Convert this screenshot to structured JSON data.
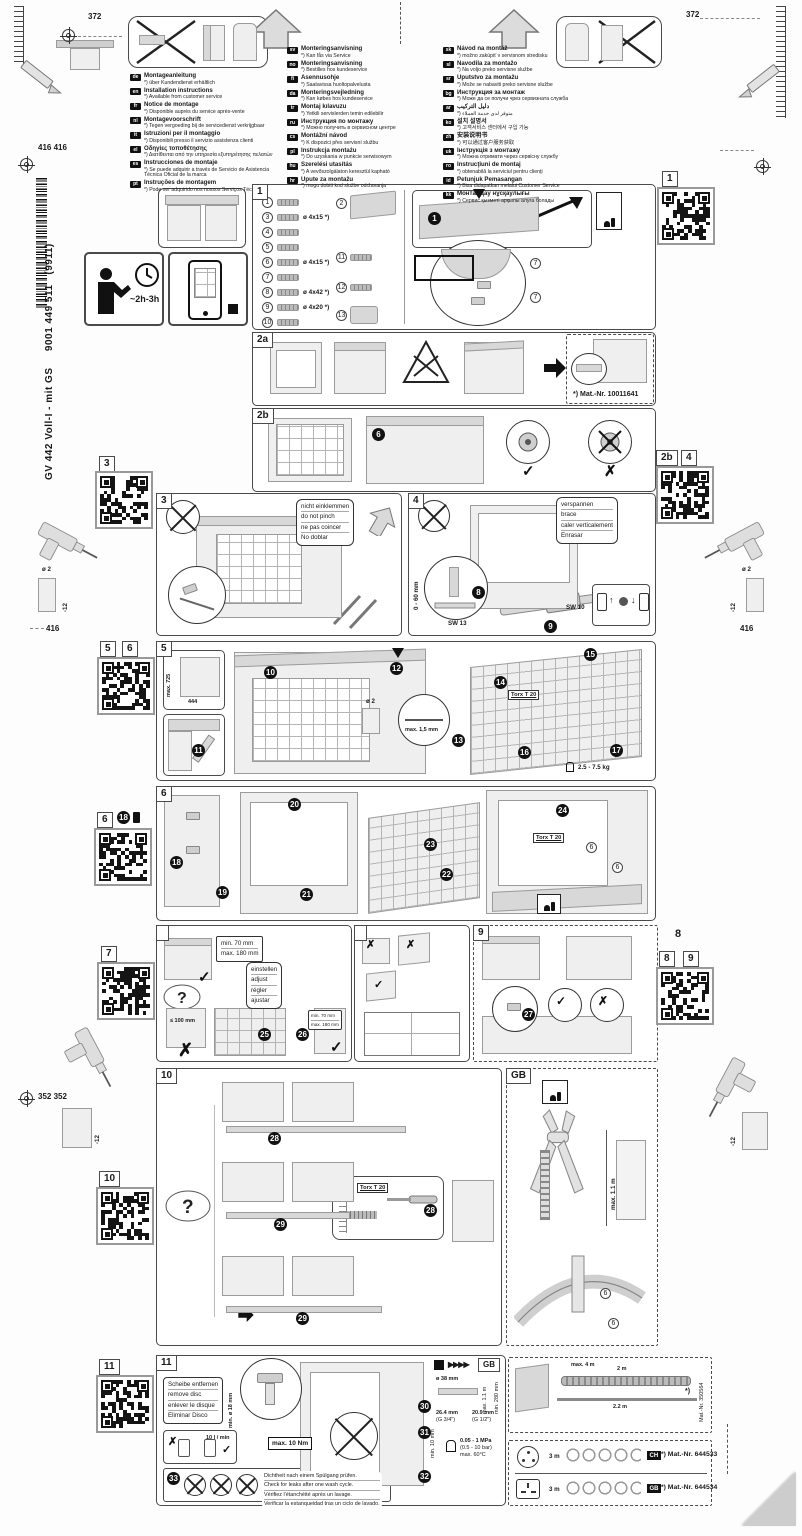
{
  "meta": {
    "product": "GV 442 Voll-I - mit GS",
    "doc_number": "9001 449 511",
    "doc_revision": "(9911)",
    "duration": "~2h-3h"
  },
  "dims": {
    "d372": "372",
    "d416416": "416 416",
    "d416": "416",
    "d352352": "352 352",
    "drill_dia": "ø 2",
    "drill_depth": "-12"
  },
  "glyphs": {
    "check": "✓",
    "cross": "✗",
    "question": "?",
    "asterisk": "*)"
  },
  "languages": {
    "col1": [
      {
        "code": "de",
        "title": "Montageanleitung",
        "note": "*) über Kundendienst erhältlich"
      },
      {
        "code": "en",
        "title": "Installation instructions",
        "note": "*) Available from customer service"
      },
      {
        "code": "fr",
        "title": "Notice de montage",
        "note": "*) Disponible auprès du service après-vente"
      },
      {
        "code": "nl",
        "title": "Montagevoorschrift",
        "note": "*) Tegen vergoeding bij de servicedienst verkrijgbaar"
      },
      {
        "code": "it",
        "title": "Istruzioni per il montaggio",
        "note": "*) Disponibili presso il servizio assistenza clienti"
      },
      {
        "code": "el",
        "title": "Οδηγίες τοποθέτησης",
        "note": "*) Διατίθενται από την υπηρεσία εξυπηρέτησης πελατών"
      },
      {
        "code": "es",
        "title": "Instrucciones de montaje",
        "note": "*) Se puede adquirir a través de Servicio de Asistencia Técnica Oficial de la marca"
      },
      {
        "code": "pt",
        "title": "Instruções de montagem",
        "note": "*) Pode ser adquirido nos nossos Serviços Técnicos"
      }
    ],
    "col2": [
      {
        "code": "sv",
        "title": "Monteringsanvisning",
        "note": "*) Kan fås via Service"
      },
      {
        "code": "no",
        "title": "Monteringsanvisning",
        "note": "*) Bestilles hos kundeservice"
      },
      {
        "code": "fi",
        "title": "Asennusohje",
        "note": "*) Saatavissa huoltopalvelusta"
      },
      {
        "code": "da",
        "title": "Monteringsvejledning",
        "note": "*) Kan købes hos kundeservice"
      },
      {
        "code": "tr",
        "title": "Montaj kılavuzu",
        "note": "*) Yetkili servislerden temin edilebilir"
      },
      {
        "code": "ru",
        "title": "Инструкция по монтажу",
        "note": "*) Можно получить в сервисном центре"
      },
      {
        "code": "cs",
        "title": "Montážní návod",
        "note": "*) K dispozici přes servisní službu"
      },
      {
        "code": "pl",
        "title": "Instrukcja montażu",
        "note": "*) Do uzyskania w punkcie serwisowym"
      },
      {
        "code": "hu",
        "title": "Szerelési utasítás",
        "note": "*) A vevőszolgálaton keresztül kapható"
      },
      {
        "code": "hr",
        "title": "Upute za montažu",
        "note": "*) mogu dobiti kod službe održavanja"
      }
    ],
    "col3": [
      {
        "code": "sk",
        "title": "Návod na montáž",
        "note": "*) možno zakúpiť v servisnom stredisku"
      },
      {
        "code": "sl",
        "title": "Navodila za montažo",
        "note": "*) Na voljo preko servisne službe"
      },
      {
        "code": "sr",
        "title": "Uputstvo za montažu",
        "note": "*) Može se nabaviti preko servisne službe"
      },
      {
        "code": "bg",
        "title": "Инструкция за монтаж",
        "note": "*) Може да се получи чрез сервизната служба"
      },
      {
        "code": "ar",
        "title": "دليل التركيب",
        "note": "*) متوفر لدى خدمة العملاء"
      },
      {
        "code": "ko",
        "title": "설치 설명서",
        "note": "*) 고객서비스 센터에서 구입 가능"
      },
      {
        "code": "zh",
        "title": "安装说明书",
        "note": "*) 可以通过客户服务获取"
      },
      {
        "code": "uk",
        "title": "Інструкція з монтажу",
        "note": "*) Можна отримати через сервісну службу"
      },
      {
        "code": "ro",
        "title": "Instrucţiuni de montaj",
        "note": "*) obtenabilă la serviciul pentru clienţi"
      },
      {
        "code": "id",
        "title": "Petunjuk Pemasangan",
        "note": "*) Bisa didapatkan melalui Customer Service"
      },
      {
        "code": "kk",
        "title": "Монтаждау нұсқаулығы",
        "note": "*) Сервис қызметі арқылы алуға болады"
      }
    ]
  },
  "steps": {
    "s1": "1",
    "s2a": "2a",
    "s2b": "2b",
    "s3": "3",
    "s4": "4",
    "s5": "5",
    "s6": "6",
    "s9": "9",
    "s10": "10",
    "s11": "11",
    "gb": "GB",
    "s8_floating": "8"
  },
  "qr_labels": {
    "q1": "1",
    "q2b": "2b",
    "q4": "4",
    "q3": "3",
    "q5": "5",
    "q6": "6",
    "q6b": "6",
    "q18": "18",
    "q7": "7",
    "q8": "8",
    "q9": "9",
    "q10": "10",
    "q11": "11"
  },
  "nums": {
    "n1": "1",
    "n2": "2",
    "n3": "3",
    "n4": "4",
    "n5": "5",
    "n6": "6",
    "n7": "7",
    "n8": "8",
    "n9": "9",
    "n10": "10",
    "n11": "11",
    "n12": "12",
    "n13": "13",
    "n14": "14",
    "n15": "15",
    "n16": "16",
    "n17": "17",
    "n18": "18",
    "n19": "19",
    "n20": "20",
    "n21": "21",
    "n22": "22",
    "n23": "23",
    "n24": "24",
    "n25": "25",
    "n26": "26",
    "n27": "27",
    "n28": "28",
    "n29": "29",
    "n30": "30",
    "n31": "31",
    "n32": "32",
    "n33": "33"
  },
  "sizes": {
    "s415": "ø 4x15 *)",
    "s442": "ø 4x42 *)",
    "s420": "ø 4x20 *)"
  },
  "annot": {
    "mat_2a": "*) Mat.-Nr. 10011641",
    "torx": "Torx T 20",
    "s3_note": [
      "nicht einklemmen",
      "do not pinch",
      "ne pas coincer",
      "No doblar"
    ],
    "s4_note": [
      "verspannen",
      "brace",
      "caler verticalement",
      "Enrasar"
    ],
    "s4_range": "0 - 60 mm",
    "sw13": "SW 13",
    "sw10": "SW 10",
    "s5_h": "max. 725",
    "s5_w": "444",
    "s5_gap": "max. 1,5 mm",
    "s5_weight": "2.5 - 7.5 kg",
    "s7_min": "min. 70 mm",
    "s7_max": "max. 180 mm",
    "s7_lt": "≤ 100 mm",
    "s7_adjust": [
      "einstellen",
      "adjust",
      "régler",
      "ajustar"
    ],
    "s11_remove": [
      "Scheibe entfernen",
      "remove disc",
      "enlever le disque",
      "Eliminar Disco"
    ],
    "s11_dia": "min. ø 18 mm",
    "s11_flow": "10 l / min",
    "s11_torque": "max. 10 Nm",
    "s11_check": [
      "Dichtheit nach einem Spülgang prüfen.",
      "Check for leaks after one wash cycle.",
      "Vérifiez l'étanchéité après un lavage.",
      "Verificar la estanqueidad tras un ciclo de lavado."
    ],
    "s11_thread1a": "26.4 mm",
    "s11_thread1b": "(G 3/4\")",
    "s11_thread2a": "20.9 mm",
    "s11_thread2b": "(G 1/2\")",
    "s11_press1": "0.05 - 1 MPa",
    "s11_press2": "(0.5 - 10 bar)",
    "s11_press3": "max. 60°C",
    "s11_min10": "min. 10 mm",
    "s11_hose_dia": "ø 38 mm",
    "s11_hmax": "max. 1.1 m",
    "s11_hmin": "min. 280 mm",
    "gb_hmax": "max. 1.1 m"
  },
  "bottom": {
    "hose_max": "max. 4 m",
    "hose_2m": "2 m",
    "hose_22": "2.2 m",
    "hose_mat": "Mat.-Nr. 350564",
    "hose_ast": "*)",
    "cords": [
      {
        "len": "3 m",
        "badge": "CH",
        "mat": "*) Mat.-Nr. 644533"
      },
      {
        "len": "3 m",
        "badge": "GB",
        "mat": "*) Mat.-Nr. 644534"
      }
    ]
  }
}
